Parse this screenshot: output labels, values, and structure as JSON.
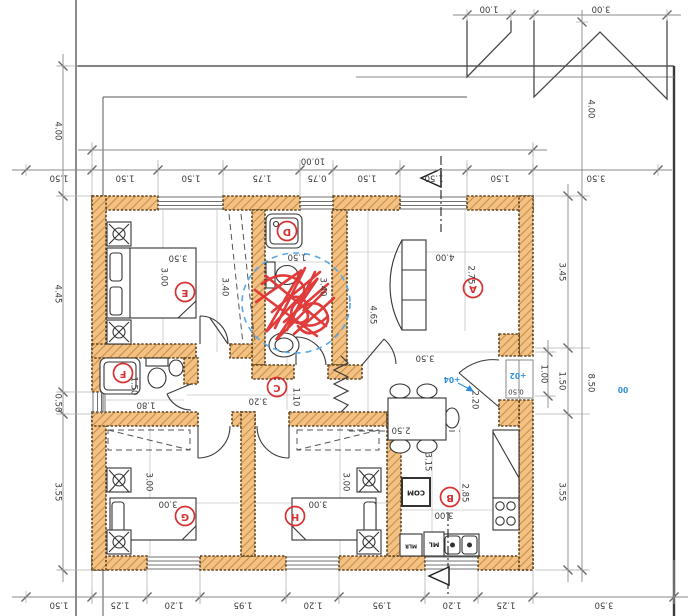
{
  "drawing_type": "architectural floor plan (rendered upside down)",
  "colors": {
    "wall_fill": "#f3c183",
    "wall_hatch": "#bc7e33",
    "wall_edge": "#5d4420",
    "line": "#3c3c3c",
    "dim_text": "#3a3a3a",
    "grid": "#c6c6c6",
    "red_annotation": "#d63031",
    "blue_annotation": "#2f8fdd"
  },
  "rooms": [
    {
      "label": "A",
      "x": 473,
      "y": 288
    },
    {
      "label": "B",
      "x": 450,
      "y": 497
    },
    {
      "label": "C",
      "x": 277,
      "y": 387
    },
    {
      "label": "D",
      "x": 287,
      "y": 231
    },
    {
      "label": "E",
      "x": 185,
      "y": 292
    },
    {
      "label": "F",
      "x": 123,
      "y": 373
    },
    {
      "label": "G",
      "x": 185,
      "y": 516
    },
    {
      "label": "H",
      "x": 295,
      "y": 516
    }
  ],
  "fixture_labels": [
    {
      "t": "COM",
      "x": 416,
      "y": 492,
      "cls": "fix"
    },
    {
      "t": "ML",
      "x": 434,
      "y": 544,
      "cls": "fix mid"
    },
    {
      "t": "MLR",
      "x": 411,
      "y": 545,
      "cls": "fix tiny"
    }
  ],
  "level_markers": [
    {
      "t": "+04",
      "x": 452,
      "y": 379
    },
    {
      "t": "+02",
      "x": 518,
      "y": 375
    },
    {
      "t": "00",
      "x": 623,
      "y": 389
    }
  ],
  "interior_dims": [
    {
      "t": "3.50",
      "x": 178,
      "y": 257,
      "o": "h"
    },
    {
      "t": "3.00",
      "x": 163,
      "y": 277,
      "o": "v"
    },
    {
      "t": "3.40",
      "x": 224,
      "y": 287,
      "o": "v"
    },
    {
      "t": "1.50",
      "x": 297,
      "y": 256,
      "o": "h"
    },
    {
      "t": "3.40",
      "x": 322,
      "y": 287,
      "o": "v"
    },
    {
      "t": "4.00",
      "x": 445,
      "y": 256,
      "o": "h"
    },
    {
      "t": "2.75",
      "x": 470,
      "y": 275,
      "o": "v"
    },
    {
      "t": "4.65",
      "x": 372,
      "y": 315,
      "o": "v"
    },
    {
      "t": "3.50",
      "x": 425,
      "y": 357,
      "o": "h"
    },
    {
      "t": "1.80",
      "x": 146,
      "y": 404,
      "o": "h"
    },
    {
      "t": "1.50",
      "x": 133,
      "y": 386,
      "o": "v"
    },
    {
      "t": "3.20",
      "x": 258,
      "y": 400,
      "o": "h"
    },
    {
      "t": "1.10",
      "x": 295,
      "y": 397,
      "o": "v"
    },
    {
      "t": "3.00",
      "x": 168,
      "y": 503,
      "o": "h"
    },
    {
      "t": "3.00",
      "x": 148,
      "y": 482,
      "o": "v"
    },
    {
      "t": "3.00",
      "x": 318,
      "y": 503,
      "o": "h"
    },
    {
      "t": "3.00",
      "x": 345,
      "y": 482,
      "o": "v"
    },
    {
      "t": "3.00",
      "x": 444,
      "y": 514,
      "o": "h"
    },
    {
      "t": "3.15",
      "x": 427,
      "y": 462,
      "o": "v"
    },
    {
      "t": "2.85",
      "x": 464,
      "y": 493,
      "o": "v"
    },
    {
      "t": "2.20",
      "x": 474,
      "y": 400,
      "o": "v"
    },
    {
      "t": "2.50",
      "x": 401,
      "y": 429,
      "o": "h"
    },
    {
      "t": "0.50",
      "x": 516,
      "y": 391,
      "o": "h",
      "small": true
    }
  ],
  "dim_chains": [
    {
      "dir": "h",
      "line": 170,
      "label_off": 177,
      "ticks": [
        26,
        92,
        158,
        223,
        300,
        333,
        400,
        467,
        533,
        658
      ],
      "labels": [
        "1.50",
        "1.50",
        "1.50",
        "1.75",
        "0.75",
        "1.50",
        "1.50",
        "1.50",
        "3.50"
      ]
    },
    {
      "dir": "h",
      "line": 150,
      "label_off": 160,
      "ticks": [
        92,
        533
      ],
      "labels": [
        "10.00"
      ]
    },
    {
      "dir": "h",
      "line": 597,
      "label_off": 604,
      "ticks": [
        26,
        92,
        147,
        200,
        286,
        339,
        425,
        478,
        533,
        674
      ],
      "labels": [
        "1.50",
        "1.25",
        "1.20",
        "1.95",
        "1.20",
        "1.95",
        "1.20",
        "1.25",
        "3.50"
      ]
    },
    {
      "dir": "v",
      "line": 63,
      "label_off": 57,
      "ticks": [
        66,
        196,
        392,
        414,
        570
      ],
      "labels": [
        "4.00",
        "4.45",
        "0.50",
        "3.55"
      ]
    },
    {
      "dir": "v",
      "line": 568,
      "label_off": 561,
      "ticks": [
        196,
        348,
        414,
        570
      ],
      "labels": [
        "3.45",
        "1.50",
        "3.55"
      ]
    },
    {
      "dir": "v",
      "line": 582,
      "label_off": 590,
      "ticks": [
        22,
        196,
        570
      ],
      "labels": [
        "4.00",
        "8.50"
      ]
    },
    {
      "dir": "v",
      "line": 548,
      "label_off": 543,
      "ticks": [
        352,
        396
      ],
      "labels": [
        "1.00"
      ]
    },
    {
      "dir": "h",
      "line": 15,
      "label_off": 8,
      "ticks": [
        467,
        511
      ],
      "labels": [
        "1.00"
      ]
    },
    {
      "dir": "h",
      "line": 15,
      "label_off": 8,
      "ticks": [
        534,
        667
      ],
      "labels": [
        "3.00"
      ]
    }
  ]
}
